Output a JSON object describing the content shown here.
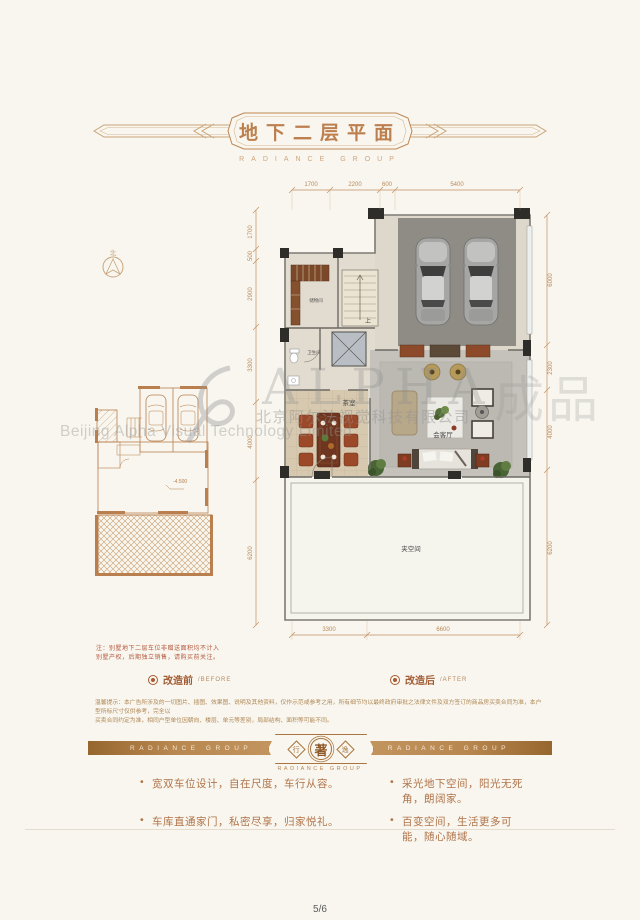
{
  "header": {
    "title": "地下二层平面",
    "subtitle": "RADIANCE GROUP"
  },
  "compass": {
    "north": "北"
  },
  "note": {
    "line1": "注：别墅地下二层车位非赠送面积均不计入",
    "line2": "别墅产权，后期独立销售，请购买前关注。"
  },
  "plan": {
    "rooms": {
      "storage": "储物间",
      "bath": "卫生间",
      "up": "上",
      "tea": "茶室",
      "living": "会客厅",
      "mezz": "夹空间"
    },
    "level_before": "-4.500",
    "dims": {
      "top": [
        "1700",
        "2200",
        "600",
        "5400"
      ],
      "left": [
        "1700",
        "500",
        "2900",
        "3300",
        "4000",
        "6200"
      ],
      "right": [
        "6000",
        "2300",
        "4000",
        "6200"
      ],
      "bottom": [
        "3300",
        "6600"
      ]
    }
  },
  "legend": {
    "before_zh": "改造前",
    "before_en": "/BEFORE",
    "after_zh": "改造后",
    "after_en": "/AFTER"
  },
  "disclaimer": {
    "line1": "温馨提示：本广告所涉及的一切图片、插图、效果图、说明及其他资料，仅作示范或参考之用，所有细节均以最终政府审批之法律文件及双方签订的商品房买卖合同为准，本户型所标尺寸仅供参考，完全以",
    "line2": "买卖合同约定为准，相同户型单位因朝向、楼层、单元等差别，局部结构、面积等可能不同。"
  },
  "footer": {
    "brand_left": "RADIANCE GROUP",
    "brand_right": "RADIANCE GROUP",
    "emblem_left": "行",
    "emblem_center": "著",
    "emblem_right": "逸",
    "brand_sub": "RADIANCE GROUP"
  },
  "bullets": [
    "宽双车位设计，自在尺度，车行从容。",
    "采光地下空间，阳光无死角，朗阔家。",
    "车库直通家门，私密尽享，归家悦礼。",
    "百变空间，生活更多可能，随心随域。"
  ],
  "watermark": {
    "big": "ALPHA",
    "big2": "成品",
    "company_zh": "北京阿尔法视觉科技有限公司",
    "company_en": "Beijing Alpha Visual Technology Limited"
  },
  "page_number": "5/6",
  "colors": {
    "accent": "#bd7f4e",
    "banner": "#a8743f",
    "plan_line": "#b97f4e",
    "wall": "#2f2d2a"
  }
}
